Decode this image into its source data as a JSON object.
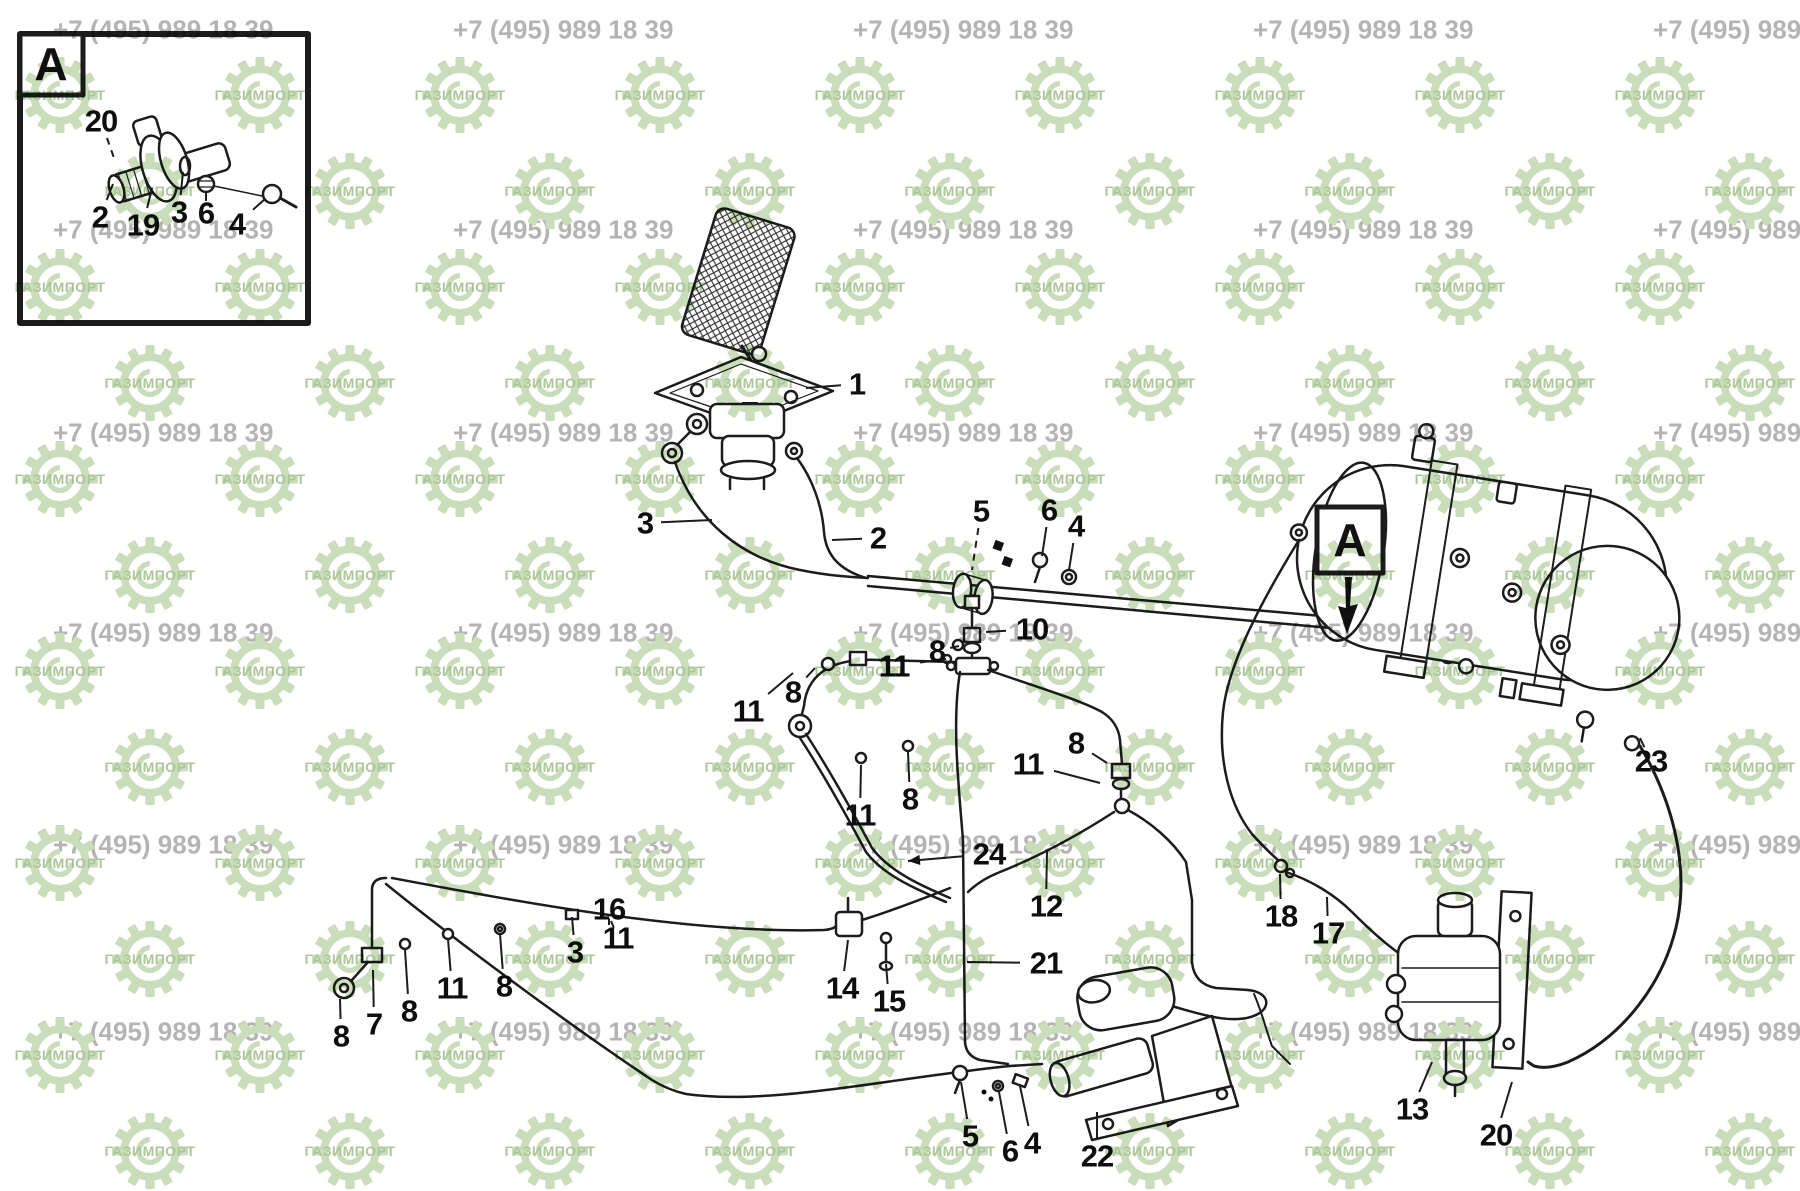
{
  "watermark": {
    "phone": "+7 (495) 989 18 39",
    "brand": "ГАЗИМПОРТ",
    "phone_color": "#b4b4b4",
    "logo_color": "#c9ddba",
    "logo_text_color": "#abc69a"
  },
  "diagram": {
    "detail_view": {
      "label": "A",
      "part_labels": [
        {
          "text": "20",
          "x": 101,
          "y": 121,
          "lx": 114,
          "ly": 158,
          "dash": true
        },
        {
          "text": "2",
          "x": 100,
          "y": 217,
          "lx": 113,
          "ly": 184
        },
        {
          "text": "19",
          "x": 143,
          "y": 225,
          "lx": 152,
          "ly": 188
        },
        {
          "text": "3",
          "x": 179,
          "y": 212,
          "lx": 183,
          "ly": 172
        },
        {
          "text": "6",
          "x": 206,
          "y": 213,
          "lx": 206,
          "ly": 193
        },
        {
          "text": "4",
          "x": 237,
          "y": 224,
          "lx": 265,
          "ly": 199
        }
      ]
    },
    "main_view": {
      "ref_label": "A",
      "part_labels": [
        {
          "text": "1",
          "x": 857,
          "y": 384,
          "lx": 806,
          "ly": 388
        },
        {
          "text": "3",
          "x": 645,
          "y": 523,
          "lx": 712,
          "ly": 520
        },
        {
          "text": "2",
          "x": 878,
          "y": 538,
          "lx": 832,
          "ly": 540
        },
        {
          "text": "5",
          "x": 981,
          "y": 511,
          "lx": 972,
          "ly": 570,
          "dash": true
        },
        {
          "text": "6",
          "x": 1049,
          "y": 510,
          "lx": 1042,
          "ly": 556
        },
        {
          "text": "4",
          "x": 1076,
          "y": 526,
          "lx": 1069,
          "ly": 570
        },
        {
          "text": "10",
          "x": 1032,
          "y": 629,
          "lx": 986,
          "ly": 632
        },
        {
          "text": "8",
          "x": 937,
          "y": 651,
          "lx": 959,
          "ly": 646
        },
        {
          "text": "11",
          "x": 894,
          "y": 666,
          "lx": 946,
          "ly": 659
        },
        {
          "text": "11",
          "x": 748,
          "y": 711,
          "lx": 793,
          "ly": 673
        },
        {
          "text": "8",
          "x": 793,
          "y": 692,
          "lx": 815,
          "ly": 668
        },
        {
          "text": "8",
          "x": 910,
          "y": 799,
          "lx": 908,
          "ly": 752
        },
        {
          "text": "11",
          "x": 860,
          "y": 815,
          "lx": 861,
          "ly": 765
        },
        {
          "text": "24",
          "x": 989,
          "y": 854,
          "lx": 908,
          "ly": 861,
          "arrow": true
        },
        {
          "text": "12",
          "x": 1046,
          "y": 906,
          "lx": 1047,
          "ly": 851
        },
        {
          "text": "8",
          "x": 1076,
          "y": 743,
          "lx": 1107,
          "ly": 763
        },
        {
          "text": "11",
          "x": 1028,
          "y": 764,
          "lx": 1100,
          "ly": 783
        },
        {
          "text": "21",
          "x": 1046,
          "y": 963,
          "lx": 967,
          "ly": 962
        },
        {
          "text": "14",
          "x": 842,
          "y": 988,
          "lx": 848,
          "ly": 940
        },
        {
          "text": "15",
          "x": 889,
          "y": 1001,
          "lx": 886,
          "ly": 964
        },
        {
          "text": "16",
          "x": 609,
          "y": 909,
          "lx": 609,
          "ly": 925
        },
        {
          "text": "3",
          "x": 575,
          "y": 952,
          "lx": 572,
          "ly": 917
        },
        {
          "text": "11",
          "x": 618,
          "y": 938,
          "lx": 611,
          "ly": 921
        },
        {
          "text": "8",
          "x": 504,
          "y": 986,
          "lx": 500,
          "ly": 934
        },
        {
          "text": "11",
          "x": 452,
          "y": 988,
          "lx": 448,
          "ly": 939
        },
        {
          "text": "8",
          "x": 409,
          "y": 1011,
          "lx": 405,
          "ly": 950
        },
        {
          "text": "7",
          "x": 374,
          "y": 1024,
          "lx": 373,
          "ly": 970
        },
        {
          "text": "8",
          "x": 341,
          "y": 1036,
          "lx": 340,
          "ly": 999
        },
        {
          "text": "5",
          "x": 970,
          "y": 1136,
          "lx": 961,
          "ly": 1082
        },
        {
          "text": "6",
          "x": 1010,
          "y": 1151,
          "lx": 999,
          "ly": 1092
        },
        {
          "text": "4",
          "x": 1032,
          "y": 1143,
          "lx": 1020,
          "ly": 1086
        },
        {
          "text": "22",
          "x": 1097,
          "y": 1156,
          "lx": 1097,
          "ly": 1112
        },
        {
          "text": "18",
          "x": 1281,
          "y": 916,
          "lx": 1280,
          "ly": 874
        },
        {
          "text": "17",
          "x": 1328,
          "y": 933,
          "lx": 1327,
          "ly": 897
        },
        {
          "text": "23",
          "x": 1651,
          "y": 761,
          "lx": 1640,
          "ly": 738
        },
        {
          "text": "13",
          "x": 1412,
          "y": 1109,
          "lx": 1432,
          "ly": 1062
        },
        {
          "text": "20",
          "x": 1496,
          "y": 1135,
          "lx": 1512,
          "ly": 1082
        }
      ]
    }
  }
}
